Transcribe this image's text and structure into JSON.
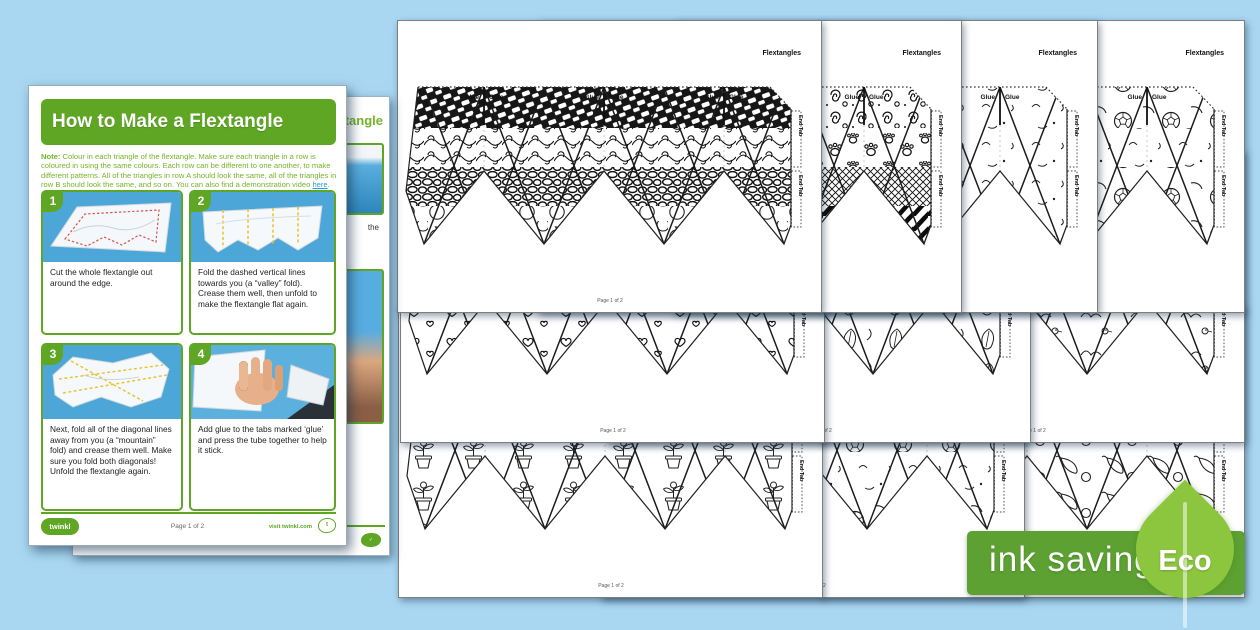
{
  "colors": {
    "background": "#a9d7f2",
    "twinkl_green": "#5fa624",
    "note_green": "#76b32a",
    "link_blue": "#2a9fd8",
    "badge_green": "#5da132",
    "leaf_green": "#8cc63f"
  },
  "instructions_page": {
    "title": "How to Make a Flextangle",
    "note_label": "Note:",
    "note_body": " Colour in each triangle of the flextangle. Make sure each triangle in a row is coloured in using the same colours. Each row can be different to one another, to make different patterns. All of the triangles in row A should look the same, all of the triangles in row B should look the same, and so on. You can also find a demonstration video ",
    "note_link": "here",
    "note_period": ".",
    "steps": [
      {
        "number": "1",
        "caption": "Cut the whole flextangle out around the edge."
      },
      {
        "number": "2",
        "caption": "Fold the dashed vertical lines towards you (a “valley” fold). Crease them well, then unfold to make the flextangle flat again."
      },
      {
        "number": "3",
        "caption": "Next, fold all of the diagonal lines away from you (a “mountain” fold) and crease them well. Make sure you fold both diagonals! Unfold the flextangle again."
      },
      {
        "number": "4",
        "caption": "Add glue to the tabs marked ‘glue’ and press the tube together to help it stick."
      }
    ],
    "footer": {
      "brand": "twinkl",
      "page_label": "Page 1 of 2",
      "site_label": "visit twinkl.com"
    }
  },
  "back_page": {
    "title_fragment": "tangle",
    "text_fragment": "the"
  },
  "template_page": {
    "title": "Flextangles",
    "glue_label": "Glue",
    "end_tab_label": "End Tab",
    "footer_label": "Page 1 of 2"
  },
  "pages": [
    {
      "id": "template-page-doodle-patterns",
      "x": 397,
      "y": 20,
      "z": 28,
      "rows": [
        "lattice",
        "swirl",
        "pebble",
        "fruit"
      ]
    },
    {
      "id": "template-page-safari",
      "x": 537,
      "y": 20,
      "z": 27,
      "rows": [
        "dswirl",
        "paw",
        "net",
        "zebra"
      ]
    },
    {
      "id": "template-page-animals",
      "x": 673,
      "y": 20,
      "z": 26,
      "rows": [
        "animal",
        "animal",
        "animal",
        "animal"
      ]
    },
    {
      "id": "template-page-sports",
      "x": 820,
      "y": 20,
      "z": 25,
      "rows": [
        "sport",
        "animal",
        "sport",
        "sport"
      ]
    },
    {
      "id": "template-page-hearts",
      "x": 400,
      "y": 150,
      "z": 18,
      "rows": [
        "hearts",
        "hearts",
        "hearts",
        "hearts"
      ]
    },
    {
      "id": "template-page-tropical-leaves",
      "x": 606,
      "y": 150,
      "z": 17,
      "rows": [
        "leaves",
        "leaves",
        "leaves",
        "leaves"
      ]
    },
    {
      "id": "template-page-birds",
      "x": 820,
      "y": 150,
      "z": 16,
      "rows": [
        "bird",
        "bird",
        "bird",
        "bird"
      ]
    },
    {
      "id": "template-page-plants",
      "x": 398,
      "y": 305,
      "z": 8,
      "rows": [
        "plant",
        "plant",
        "plant",
        "plant"
      ]
    },
    {
      "id": "template-page-games",
      "x": 600,
      "y": 305,
      "z": 7,
      "rows": [
        "sport",
        "sport",
        "animal",
        "sport"
      ]
    },
    {
      "id": "template-page-food",
      "x": 820,
      "y": 305,
      "z": 6,
      "rows": [
        "food",
        "food",
        "food",
        "food"
      ]
    }
  ],
  "eco_badge": {
    "label": "ink saving",
    "eco": "Eco"
  }
}
